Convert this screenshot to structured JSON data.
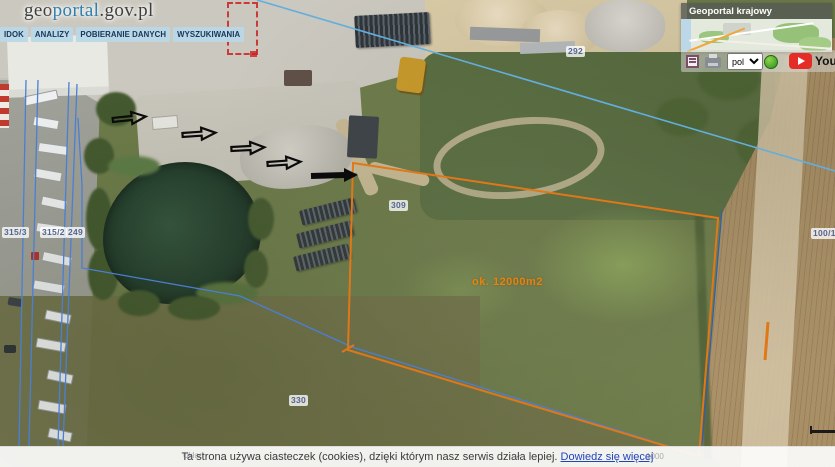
{
  "header": {
    "logo": {
      "geo": "geo",
      "portal": "portal",
      "suffix": ".gov.pl"
    },
    "menu_items": [
      {
        "label": "IDOK"
      },
      {
        "label": "ANALIZY"
      },
      {
        "label": "POBIERANIE DANYCH"
      },
      {
        "label": "WYSZUKIWANIA"
      }
    ]
  },
  "overview_map": {
    "title": "Geoportal krajowy"
  },
  "toolbar": {
    "language_selected": "pol",
    "youtube_label": "YouTube"
  },
  "map_annotations": {
    "parcel_labels": [
      {
        "text": "292"
      },
      {
        "text": "309"
      },
      {
        "text": "330"
      },
      {
        "text": "315/3"
      },
      {
        "text": "315/2"
      },
      {
        "text": "249"
      },
      {
        "text": "100/1"
      }
    ],
    "area_label": "ok. 12000m2"
  },
  "footer": {
    "cookie_message": "Ta strona używa ciasteczek (cookies), dzięki którym nasz serwis działa lepiej.",
    "cookie_link_label": "Dowiedz się więcej",
    "coord_hint": "Układ",
    "scale_value": "1000"
  },
  "colors": {
    "accent_orange": "#e07818",
    "area_label_orange": "#e8820c",
    "parcel_line_blue": "#4a7fd4",
    "boundary_cyan": "#62aede",
    "menu_item_bg": "#b9d8e7",
    "menu_item_text": "#15365a",
    "cookie_link_blue": "#2244bb",
    "selection_red": "#cc2222",
    "youtube_red": "#e52d27"
  }
}
